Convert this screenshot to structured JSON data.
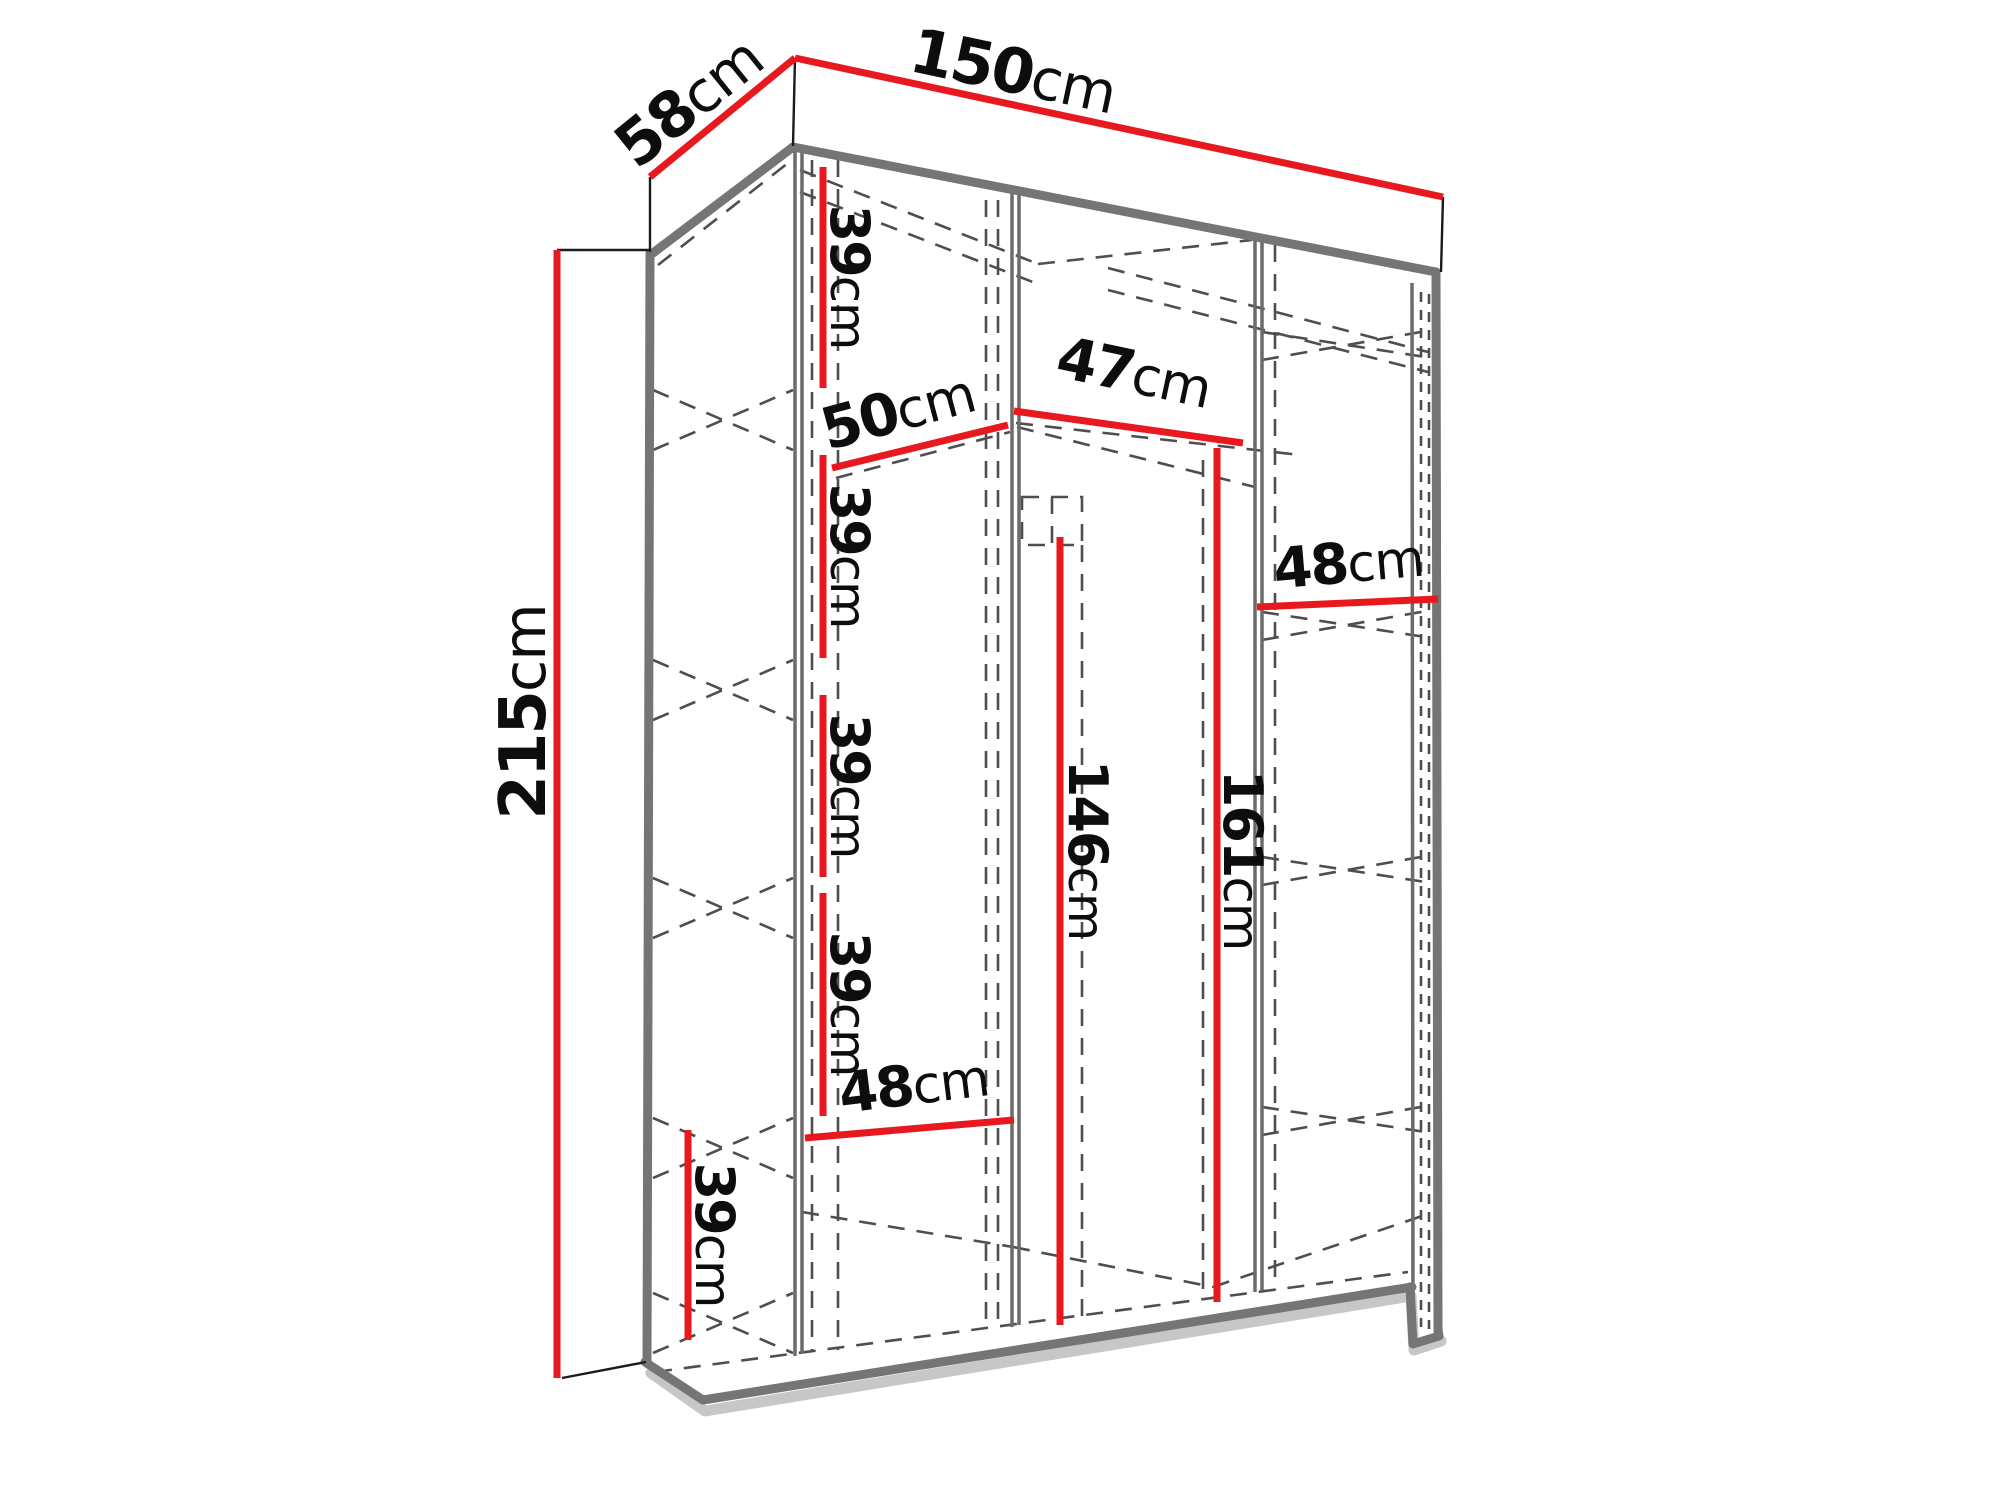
{
  "labels": {
    "depth": {
      "num": "58",
      "unit": "cm"
    },
    "width": {
      "num": "150",
      "unit": "cm"
    },
    "height": {
      "num": "215",
      "unit": "cm"
    },
    "shelf_gap_1": {
      "num": "39",
      "unit": "cm"
    },
    "shelf_gap_2": {
      "num": "39",
      "unit": "cm"
    },
    "shelf_gap_3": {
      "num": "39",
      "unit": "cm"
    },
    "shelf_gap_4": {
      "num": "39",
      "unit": "cm"
    },
    "shelf_gap_5": {
      "num": "39",
      "unit": "cm"
    },
    "inner_width_top": {
      "num": "50",
      "unit": "cm"
    },
    "inner_width_middle": {
      "num": "47",
      "unit": "cm"
    },
    "inner_width_right": {
      "num": "48",
      "unit": "cm"
    },
    "inner_width_bottom": {
      "num": "48",
      "unit": "cm"
    },
    "inner_height_left": {
      "num": "146",
      "unit": "cm"
    },
    "inner_height_right": {
      "num": "161",
      "unit": "cm"
    }
  },
  "colors": {
    "dimension_red": "#e8191e",
    "edge_gray": "#757575",
    "dashed_gray": "#4e4e4e",
    "line_black": "#1b1b1b",
    "text_black": "#0d0d0d",
    "shadow_gray": "#c7c7c7",
    "background": "#ffffff"
  }
}
